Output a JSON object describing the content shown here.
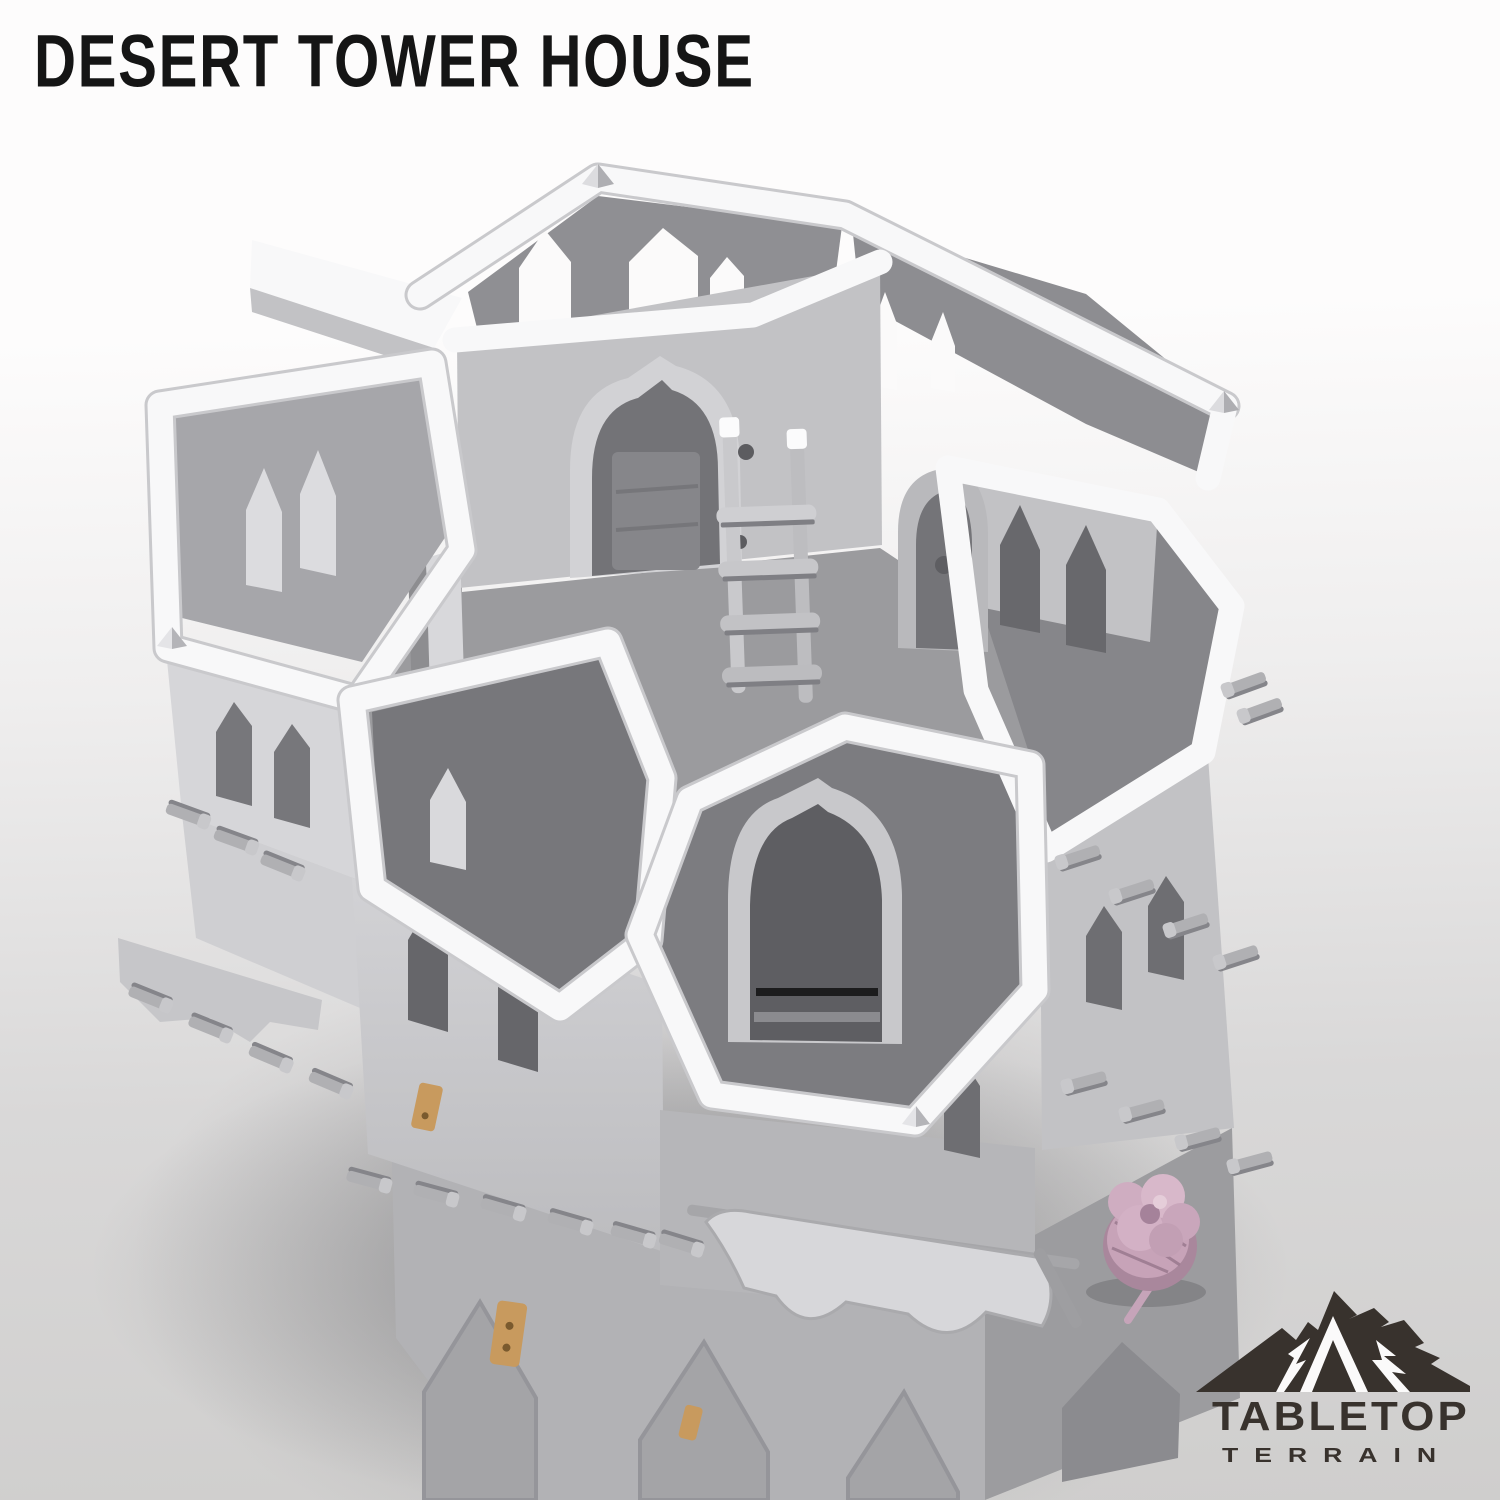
{
  "title": "DESERT TOWER HOUSE",
  "logo": {
    "name": "TABLETOP",
    "subname": "TERRAIN"
  },
  "scene": {
    "subject": "unpainted 3D tabletop terrain tower render",
    "elements": [
      "open-top walled rooms with white rims",
      "pointed-arch windows and doorways",
      "wooden ladder in courtyard",
      "scaffolding beam rows",
      "cloth awning",
      "corner spikes",
      "pink miniature knight with sword for scale"
    ]
  },
  "colors": {
    "bg-top": "#fdfcfc",
    "bg-mid": "#efeeee",
    "bg-low": "#d9d8d8",
    "bg-ground": "#a9a8a8",
    "ink": "#151515",
    "logo": "#38322d",
    "model-white": "#f8f8f9",
    "model-light": "#d6d6d9",
    "model-mid": "#c2c2c5",
    "model-shade": "#8f8f93",
    "model-dark": "#6b6b6f",
    "floor": "#9b9b9e",
    "base": "#b2b2b5",
    "base-side": "#9c9c9f",
    "beam": "#b0b0b3",
    "beam-dark": "#85858a",
    "wood": "#c89a5e",
    "mini": "#c7a3b8",
    "mini-dark": "#a9879c"
  }
}
